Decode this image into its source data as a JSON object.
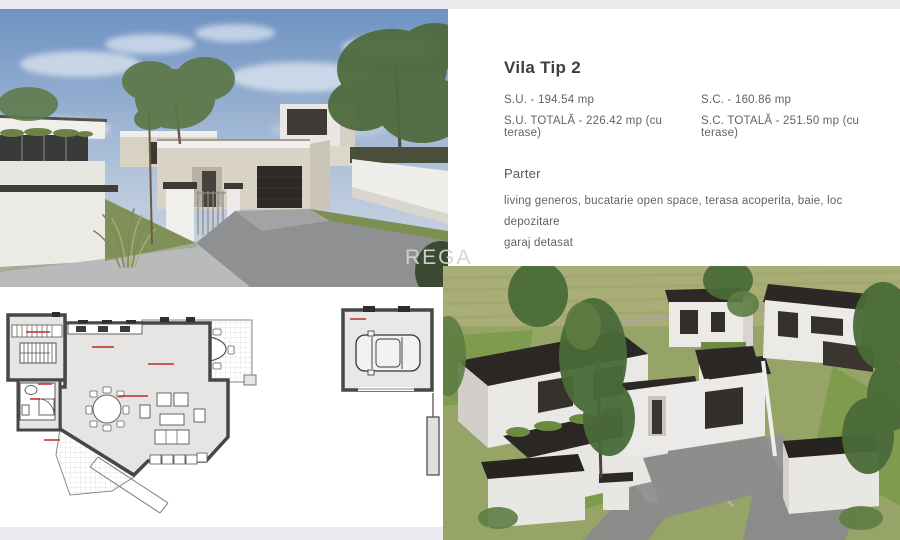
{
  "info_panel": {
    "title": "Vila Tip 2",
    "spec_su": "S.U. - 194.54 mp",
    "spec_sc": "S.C. - 160.86 mp",
    "spec_su_total": "S.U. TOTALĂ - 226.42 mp (cu terase)",
    "spec_sc_total": "S.C. TOTALĂ - 251.50 mp (cu terase)",
    "section_title": "Parter",
    "description_line1": "living generos, bucatarie open space, terasa acoperita, baie, loc depozitare",
    "description_line2": "garaj detasat"
  },
  "watermark": "REGA",
  "images": {
    "top_left": "street-render-of-modern-flat-roof-villa",
    "bottom_left": "ground-floor-plan-and-detached-garage-plan",
    "bottom_right": "aerial-render-of-villa-complex"
  },
  "colors": {
    "sky_top": "#6d92c2",
    "sky_bottom": "#cfd8e4",
    "roof_dark": "#2b2825",
    "wall_white": "#eceae6",
    "wall_beige": "#d9d3c6",
    "lawn_green": "#7f9c4e",
    "field_green": "#a9ad76",
    "plan_wall": "#474747",
    "plan_label_red": "#c0392b",
    "strip_gray": "#e9ebee",
    "text_dark": "#3c4043",
    "text_gray": "#5f6368"
  }
}
